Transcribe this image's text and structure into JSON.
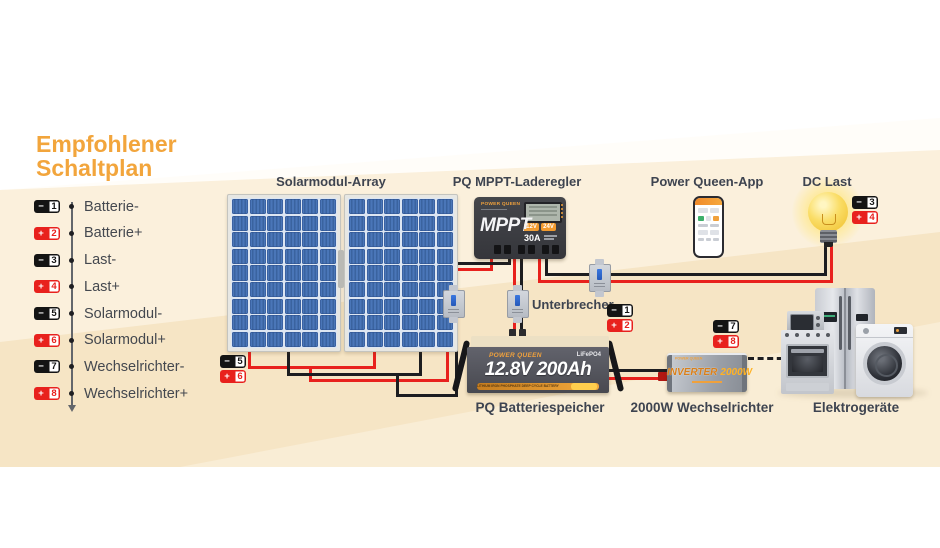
{
  "title": {
    "line1": "Empfohlener",
    "line2": "Schaltplan"
  },
  "legend": {
    "items": [
      {
        "sign": "−",
        "num": "1",
        "polarity": "neg",
        "label": "Batterie-"
      },
      {
        "sign": "+",
        "num": "2",
        "polarity": "pos",
        "label": "Batterie+"
      },
      {
        "sign": "−",
        "num": "3",
        "polarity": "neg",
        "label": "Last-"
      },
      {
        "sign": "+",
        "num": "4",
        "polarity": "pos",
        "label": "Last+"
      },
      {
        "sign": "−",
        "num": "5",
        "polarity": "neg",
        "label": "Solarmodul-"
      },
      {
        "sign": "+",
        "num": "6",
        "polarity": "pos",
        "label": "Solarmodul+"
      },
      {
        "sign": "−",
        "num": "7",
        "polarity": "neg",
        "label": "Wechselrichter-"
      },
      {
        "sign": "+",
        "num": "8",
        "polarity": "pos",
        "label": "Wechselrichter+"
      }
    ]
  },
  "labels": {
    "solar_array": "Solarmodul-Array",
    "mppt": "PQ MPPT-Laderegler",
    "app": "Power Queen-App",
    "dc_load": "DC Last",
    "breaker": "Unterbrecher",
    "battery": "PQ Batteriespeicher",
    "inverter": "2000W Wechselrichter",
    "appliances": "Elektrogeräte"
  },
  "devices": {
    "mppt": {
      "brand": "POWER QUEEN",
      "model": "MPPT",
      "rating": "30A",
      "badge_left": "12V",
      "badge_right": "24V"
    },
    "battery": {
      "brand": "POWER QUEEN",
      "chem": "LiFePO4",
      "spec": "12.8V 200Ah",
      "strip": "LITHIUM IRON PHOSPHATE DEEP CYCLE BATTERY"
    },
    "inverter": {
      "brand": "POWER QUEEN",
      "name": "INVERTER",
      "power": "2000W"
    }
  },
  "colors": {
    "accent_orange": "#F2A53C",
    "wire_red": "#E8211D",
    "wire_black": "#1D1D20",
    "badge_black": "#141414",
    "panel_blue": "#3E68AE",
    "background_cream": "#F6E5C5",
    "text": "#3E4450"
  }
}
